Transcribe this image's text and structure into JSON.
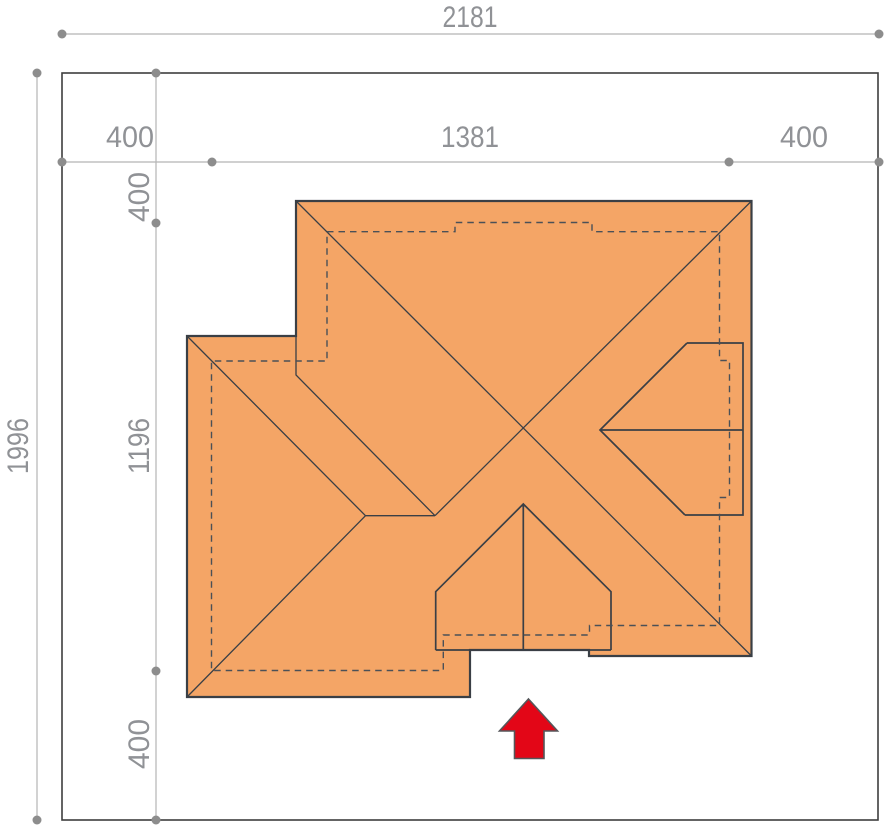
{
  "dimensions": {
    "total_width": "2181",
    "left_setback": "400",
    "building_width": "1381",
    "right_setback": "400",
    "total_height": "1996",
    "top_setback": "400",
    "building_depth": "1196",
    "bottom_setback": "400"
  },
  "arrow": {
    "direction": "up"
  },
  "colors": {
    "background": "#ffffff",
    "plot_border": "#3e3e3e",
    "dim_line": "#b5b5b5",
    "dim_dot": "#8d8d8d",
    "dim_text": "#909296",
    "roof_fill": "#f4a566",
    "roof_line": "#3a3f45",
    "dash_line": "#4a5057",
    "arrow_fill": "#e30617",
    "arrow_stroke": "#55565a"
  }
}
